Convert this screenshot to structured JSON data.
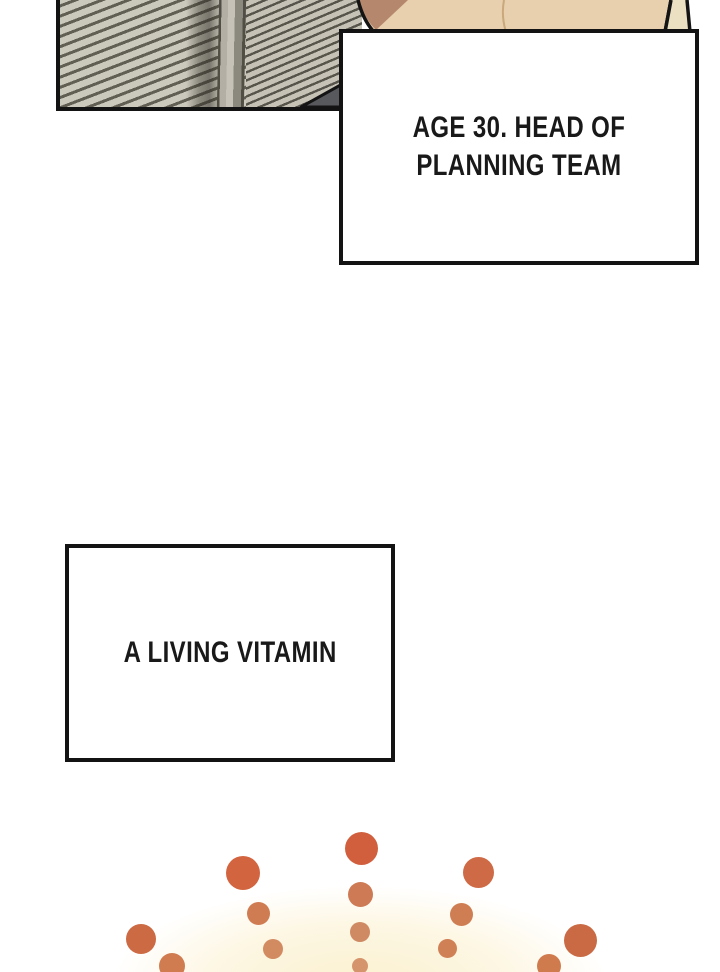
{
  "page": {
    "width": 720,
    "height": 972,
    "background": "#ffffff"
  },
  "captions": {
    "box1": "AGE 30. HEAD OF\nPLANNING TEAM",
    "box2": "A LIVING VITAMIN",
    "text_color": "#191919",
    "border_color": "#131313",
    "fill_color": "#ffffff"
  },
  "scene": {
    "blinds": {
      "slat_color": "#cbc8bc",
      "gap_color": "#615e53",
      "right_slat_color": "#c6c3b6",
      "right_gap_color": "#57544b",
      "divider_light": "#c6c2b8",
      "divider_dark": "#514e46",
      "panel_border": "#131313"
    },
    "person": {
      "skin": "#e8cfad",
      "shade": "#b5886e",
      "hair_strip": "#ece0c2",
      "outline": "#141414",
      "contour": "#c9a87b"
    },
    "silhouette_triangle": "#58595c"
  },
  "sparkle": {
    "glow_color": "rgba(251,240,205,0.9)",
    "dots": [
      {
        "cx": 361,
        "cy": 848,
        "r": 16.5,
        "color": "#d15f3d"
      },
      {
        "cx": 360,
        "cy": 894,
        "r": 12.5,
        "color": "#cd7a55"
      },
      {
        "cx": 360,
        "cy": 932,
        "r": 10,
        "color": "#cf8a64"
      },
      {
        "cx": 360,
        "cy": 966,
        "r": 8,
        "color": "#d6946c"
      },
      {
        "cx": 243,
        "cy": 873,
        "r": 17,
        "color": "#d2643f"
      },
      {
        "cx": 258,
        "cy": 913,
        "r": 11.5,
        "color": "#d07c53"
      },
      {
        "cx": 273,
        "cy": 949,
        "r": 10,
        "color": "#d28a60"
      },
      {
        "cx": 478,
        "cy": 872,
        "r": 15.5,
        "color": "#ce6a45"
      },
      {
        "cx": 461,
        "cy": 914,
        "r": 11.5,
        "color": "#cf7d52"
      },
      {
        "cx": 447,
        "cy": 948,
        "r": 9.5,
        "color": "#d08055"
      },
      {
        "cx": 141,
        "cy": 939,
        "r": 15,
        "color": "#cc6a43"
      },
      {
        "cx": 172,
        "cy": 966,
        "r": 13,
        "color": "#d07c50"
      },
      {
        "cx": 580,
        "cy": 940,
        "r": 16.5,
        "color": "#c96a44"
      },
      {
        "cx": 549,
        "cy": 966,
        "r": 12,
        "color": "#d07b4e"
      }
    ]
  }
}
